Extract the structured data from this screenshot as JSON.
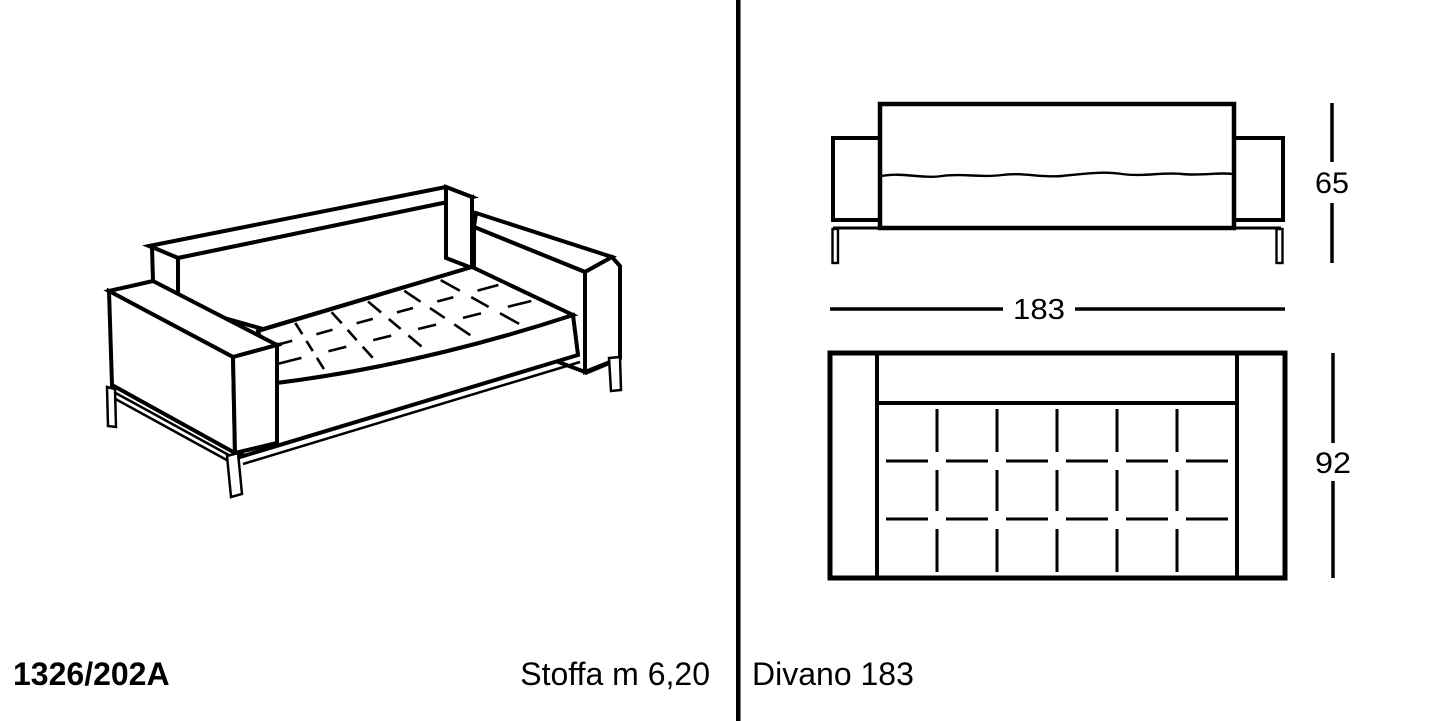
{
  "page": {
    "background_color": "#ffffff",
    "line_color": "#000000"
  },
  "footer": {
    "model_code": "1326/202A",
    "fabric_label": "Stoffa m 6,20",
    "product_label": "Divano 183"
  },
  "dimensions": {
    "width_cm": "183",
    "height_cm": "65",
    "depth_cm": "92"
  }
}
